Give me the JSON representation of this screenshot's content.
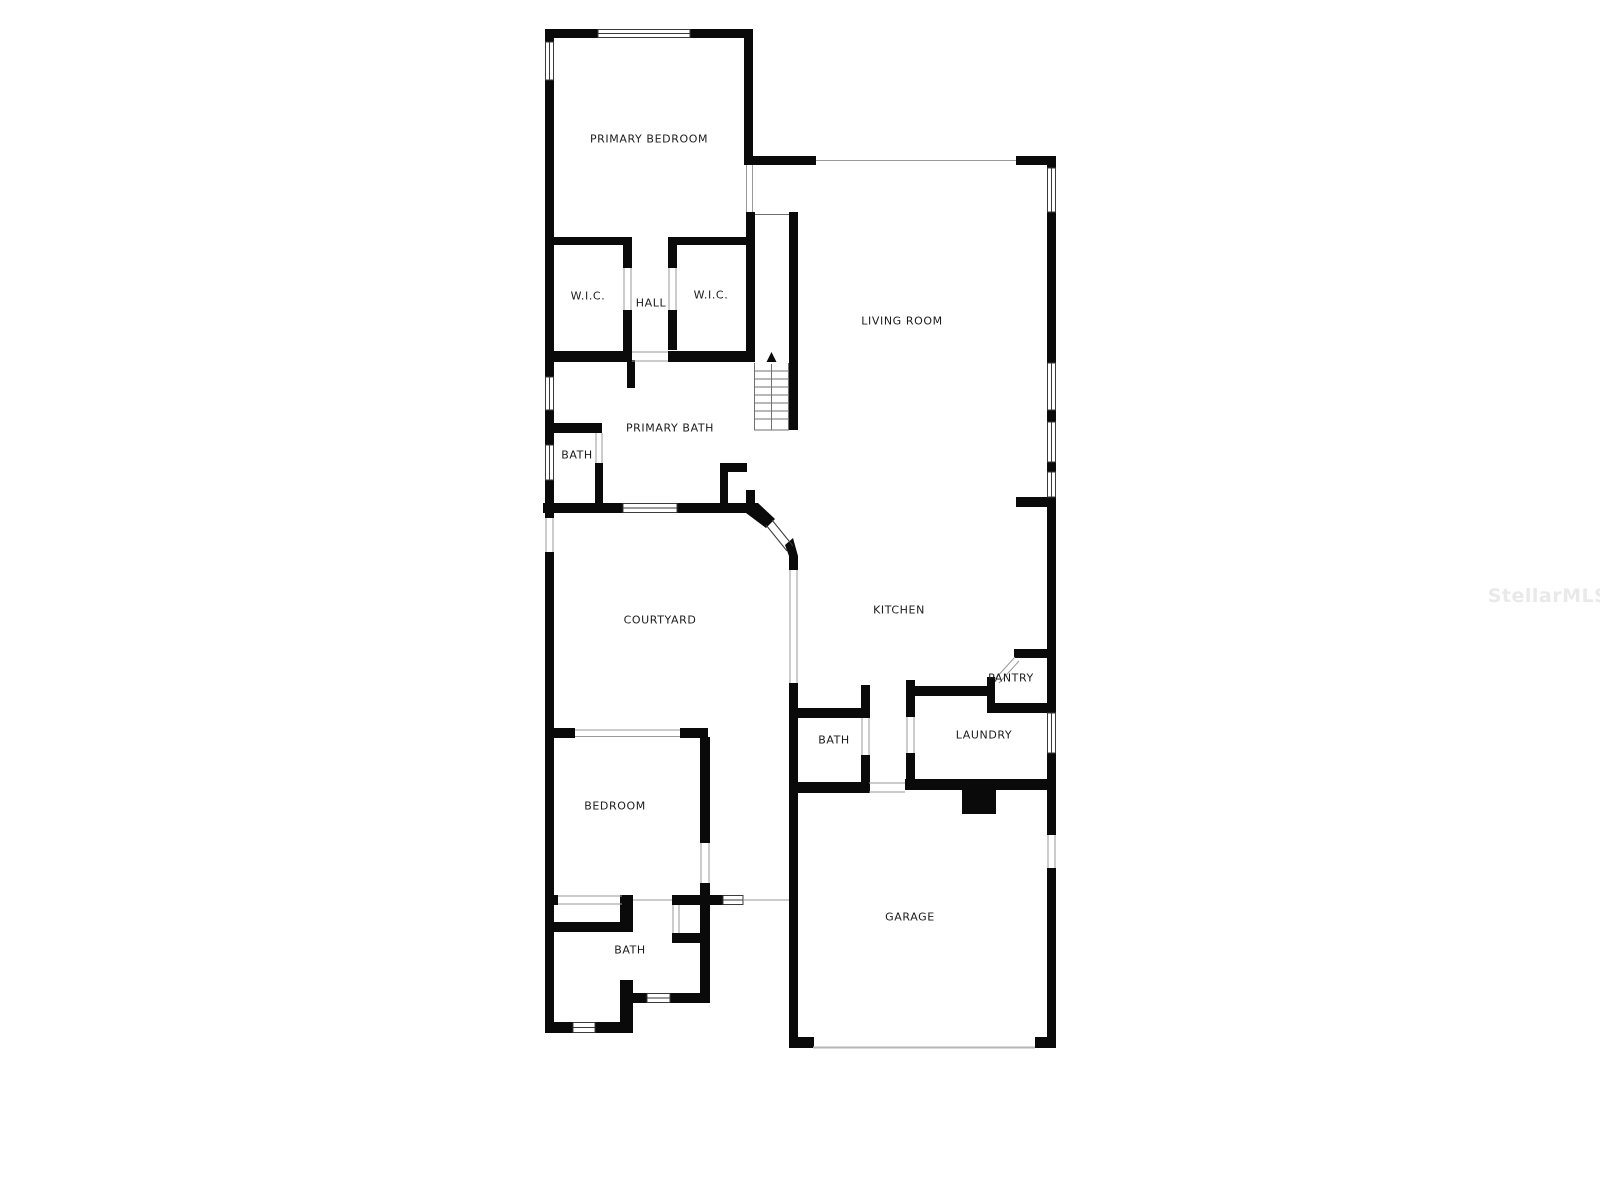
{
  "floorplan": {
    "rooms": [
      {
        "label": "PRIMARY BEDROOM"
      },
      {
        "label": "W.I.C."
      },
      {
        "label": "HALL"
      },
      {
        "label": "W.I.C."
      },
      {
        "label": "LIVING ROOM"
      },
      {
        "label": "PRIMARY BATH"
      },
      {
        "label": "BATH"
      },
      {
        "label": "COURTYARD"
      },
      {
        "label": "KITCHEN"
      },
      {
        "label": "PANTRY"
      },
      {
        "label": "BATH"
      },
      {
        "label": "LAUNDRY"
      },
      {
        "label": "BEDROOM"
      },
      {
        "label": "BATH"
      },
      {
        "label": "GARAGE"
      }
    ],
    "colors": {
      "wall": "#0a0a0a",
      "background": "#ffffff",
      "label": "#1b1b1b",
      "opening_line": "#9a9a9a",
      "stair_line": "#777777",
      "watermark": "#e9e9e9"
    }
  },
  "watermark": {
    "text": "StellarMLS"
  }
}
